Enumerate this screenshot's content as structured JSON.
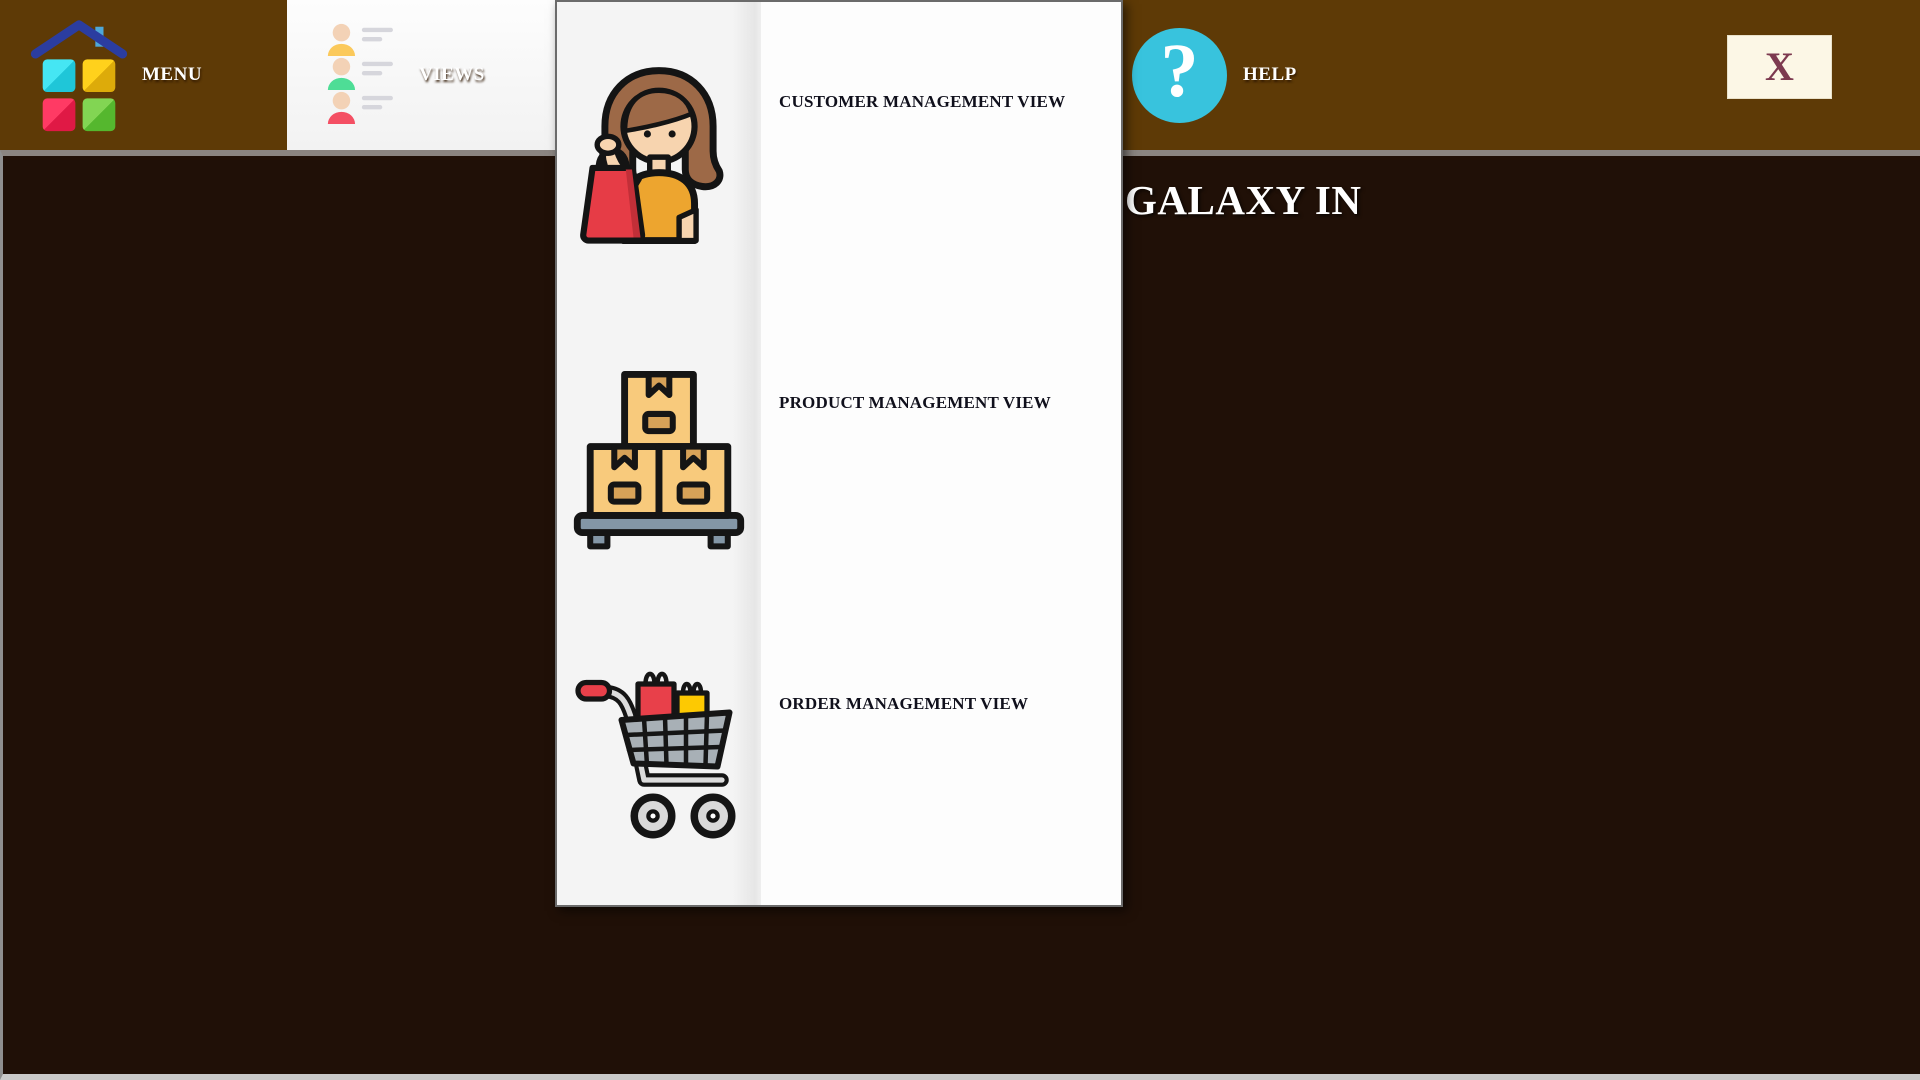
{
  "menubar": {
    "menu": {
      "label": "MENU",
      "icon": "house-grid-icon"
    },
    "views": {
      "label": "VIEWS",
      "icon": "user-list-icon",
      "state": "open"
    },
    "help": {
      "label": "HELP",
      "icon": "question-mark-circle-icon",
      "glyph": "?"
    },
    "close": {
      "label": "X"
    }
  },
  "dropdown": {
    "items": [
      {
        "label": "CUSTOMER MANAGEMENT VIEW",
        "icon": "woman-shopper-icon"
      },
      {
        "label": "PRODUCT MANAGEMENT VIEW",
        "icon": "stacked-boxes-icon"
      },
      {
        "label": "ORDER MANAGEMENT VIEW",
        "icon": "shopping-cart-icon"
      }
    ]
  },
  "content": {
    "heading_visible": "GALAXY IN"
  },
  "colors": {
    "topbar_brown": "#5e3a06",
    "content_dark_brown": "#201007",
    "help_circle_cyan": "#38c3dd",
    "close_bg_cream": "#fcf7e6",
    "close_x_maroon": "#7d3a50",
    "panel_bg": "#fdfdfd",
    "panel_icon_column": "#f4f4f4",
    "dropdown_label_text": "#10101c",
    "bar_text": "#ffffff"
  }
}
